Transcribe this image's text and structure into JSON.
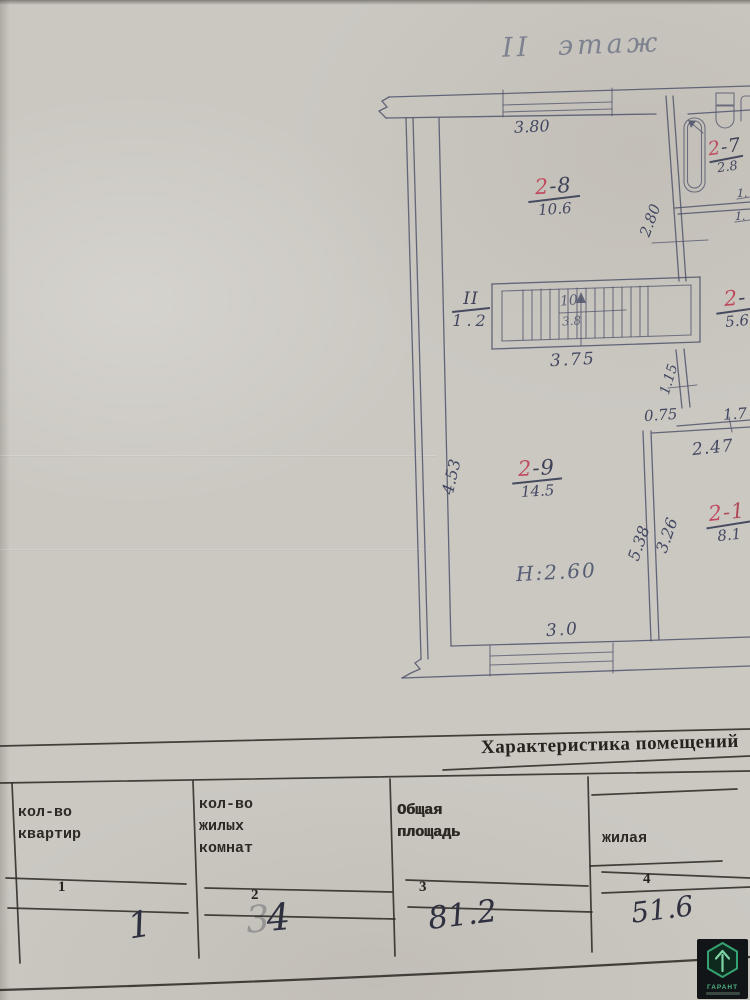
{
  "plan": {
    "title": "II этаж",
    "height_note": "Н:2.60",
    "rooms": {
      "r27": {
        "num_red": "2",
        "num_rest": "-7",
        "area": "2.8"
      },
      "r28": {
        "num_red": "2",
        "num_rest": "-8",
        "area": "10.6"
      },
      "r26": {
        "num_red": "2",
        "num_rest": "-",
        "area": "5.6"
      },
      "r29": {
        "num_red": "2",
        "num_rest": "-9",
        "area": "14.5"
      },
      "r21": {
        "num_red": "2",
        "num_rest": "-1",
        "area": "8.1"
      }
    },
    "stairs": {
      "corridor_num": "II",
      "corridor_area": "1.2",
      "flight_mark": "10",
      "flight_note": "3.8"
    },
    "dims": {
      "top_width": "3.80",
      "bath_height": "2.80",
      "stair_length": "3.75",
      "door_a": "1.15",
      "door_b": "0.75",
      "hall_width": "2.47",
      "right_cut": "1.7",
      "left_height": "4.53",
      "wall_left": "5.38",
      "wall_right": "3.26",
      "bottom_width": "3.0",
      "tick_a": "1.",
      "tick_b": "1."
    }
  },
  "table": {
    "title": "Характеристика помещений",
    "columns": [
      {
        "num": "1",
        "header": "кол-во\nквартир",
        "value": "1"
      },
      {
        "num": "2",
        "header": "кол-во\nжилых\nкомнат",
        "value": "34",
        "value_faded_part": "3",
        "value_main_part": "4"
      },
      {
        "num": "3",
        "header": "Общая\nплощадь",
        "value": "81.2"
      },
      {
        "num": "4",
        "header": "жилая",
        "value": "51.6"
      }
    ]
  },
  "watermark": {
    "brand": "ГАРАНТ"
  }
}
